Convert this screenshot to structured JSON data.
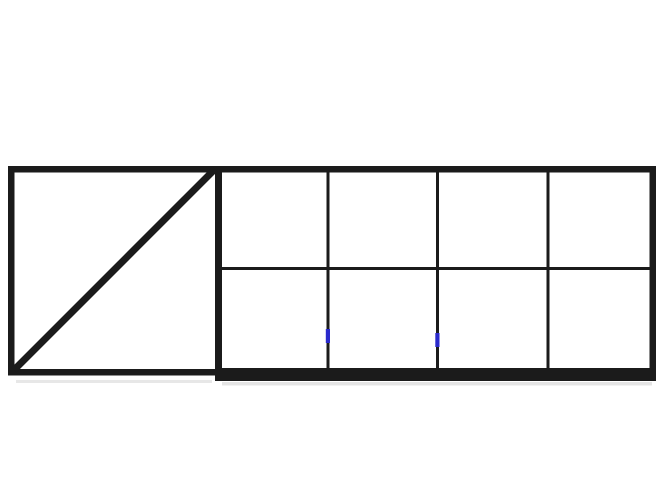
{
  "figure": {
    "type": "line-diagram",
    "description": "Black outline drawing of a sliding gate frame: left square panel with a diagonal brace, right section divided into a 4x2 grid of open panels",
    "colors": {
      "frame": "#1b1b1b",
      "marker_blue": "#2a2acc",
      "shadow": "#c9c9c9",
      "background": "#ffffff"
    },
    "panels": {
      "left_panel_count": 1,
      "right_grid_columns": 4,
      "right_grid_rows": 2
    },
    "markers": [
      {
        "name": "blue-tick-left"
      },
      {
        "name": "blue-tick-right"
      }
    ]
  }
}
